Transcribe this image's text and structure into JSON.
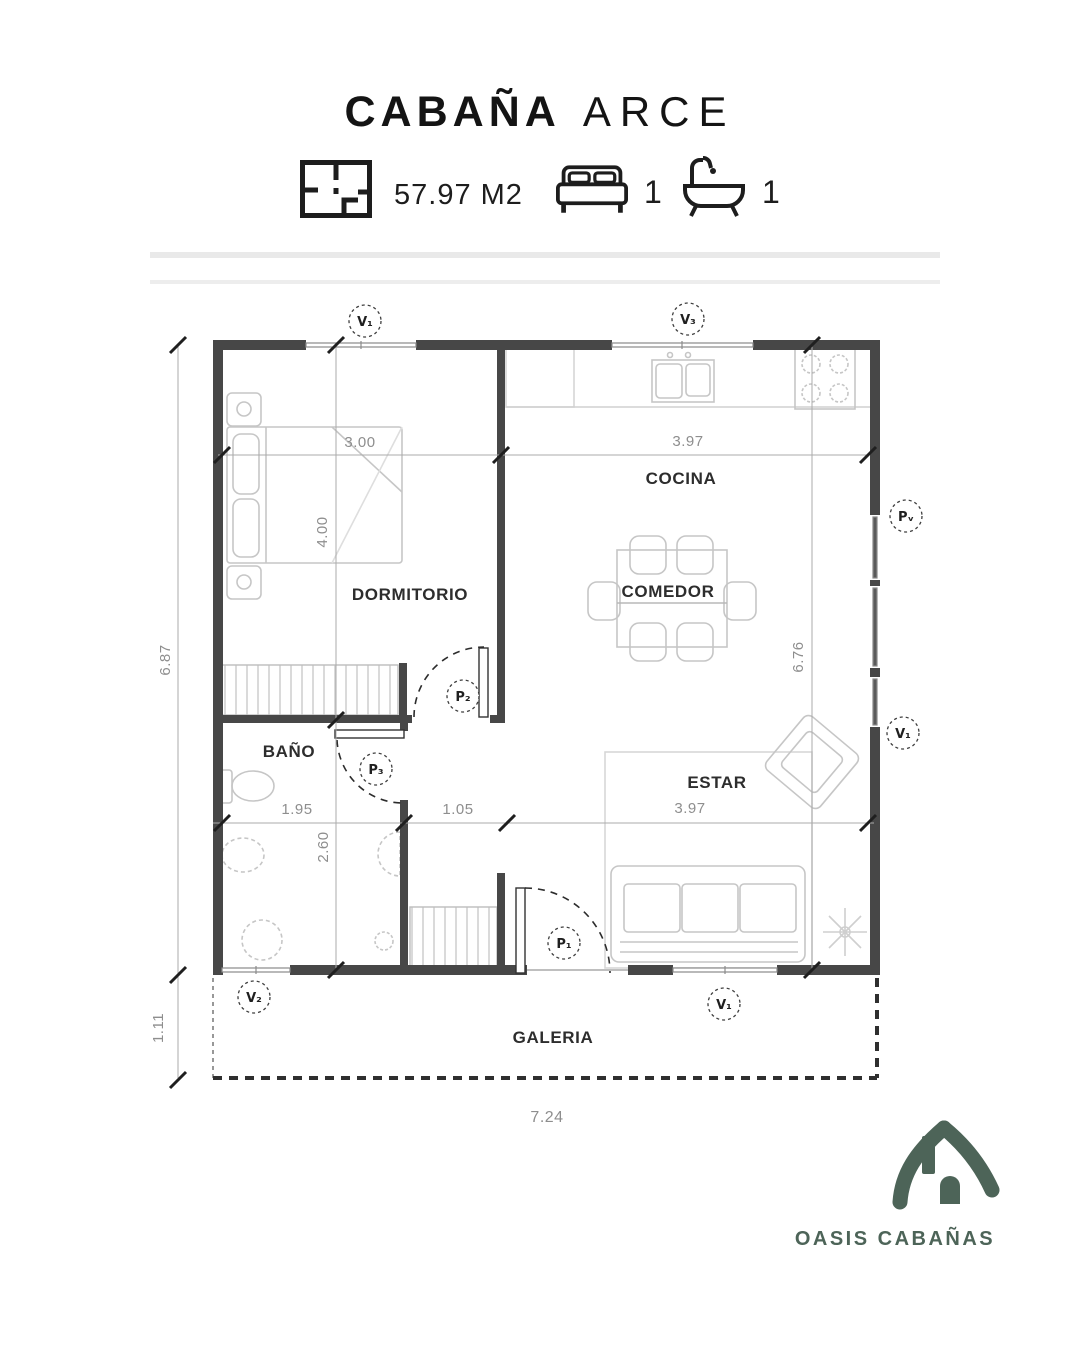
{
  "header": {
    "title": {
      "primary": "CABAÑA",
      "secondary": "ARCE"
    },
    "stats": {
      "area": "57.97 M2",
      "bedrooms": "1",
      "bathrooms": "1"
    }
  },
  "plan": {
    "rooms": {
      "dormitorio": "DORMITORIO",
      "cocina": "COCINA",
      "comedor": "COMEDOR",
      "estar": "ESTAR",
      "bano": "BAÑO",
      "galeria": "GALERIA"
    },
    "dims": {
      "total_width": "7.24",
      "left_height": "6.87",
      "galeria_depth": "1.11",
      "dorm_width": "3.00",
      "dorm_height": "4.00",
      "cocina_width": "3.97",
      "interior_height": "6.76",
      "bano_width": "1.95",
      "pasillo_width": "1.05",
      "bano_height": "2.60",
      "estar_width": "3.97"
    },
    "openings": {
      "window_top_left": "V₁",
      "window_top_right": "V₃",
      "window_bottom_left": "V₂",
      "window_bottom_right": "V₁",
      "window_right": "V₁",
      "door_right": "Pᵥ",
      "door_main": "P₁",
      "door_dorm": "P₂",
      "door_bano": "P₃"
    }
  },
  "footer": {
    "brand": "OASIS CABAÑAS"
  },
  "colors": {
    "brand": "#4d6458",
    "wall": "#474747"
  }
}
